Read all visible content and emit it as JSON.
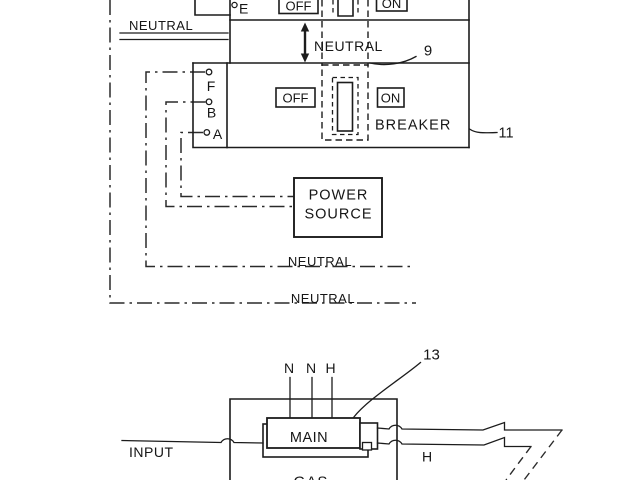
{
  "colors": {
    "ink": "#1c1c1c",
    "background": "#ffffff"
  },
  "top_diagram": {
    "feed_neutral_label": "NEUTRAL",
    "upper_breaker": {
      "terminal_e_label": "E",
      "off_label": "OFF",
      "on_label": "ON"
    },
    "neutral_bus": {
      "label": "NEUTRAL",
      "ref_numeral": "9"
    },
    "lower_breaker": {
      "terminal_f_label": "F",
      "terminal_b_label": "B",
      "terminal_a_label": "A",
      "off_label": "OFF",
      "on_label": "ON",
      "name_label": "BREAKER",
      "ref_numeral": "11"
    },
    "power_source": {
      "line1": "POWER",
      "line2": "SOURCE"
    },
    "neutral_wire1_label": "NEUTRAL",
    "neutral_wire2_label": "NEUTRAL"
  },
  "bottom_diagram": {
    "ref_numeral": "13",
    "wire_n1_label": "N",
    "wire_n2_label": "N",
    "wire_h_label": "H",
    "main_label": "MAIN",
    "input_label": "INPUT",
    "hot_label": "H",
    "appliance_label": "GAS"
  }
}
